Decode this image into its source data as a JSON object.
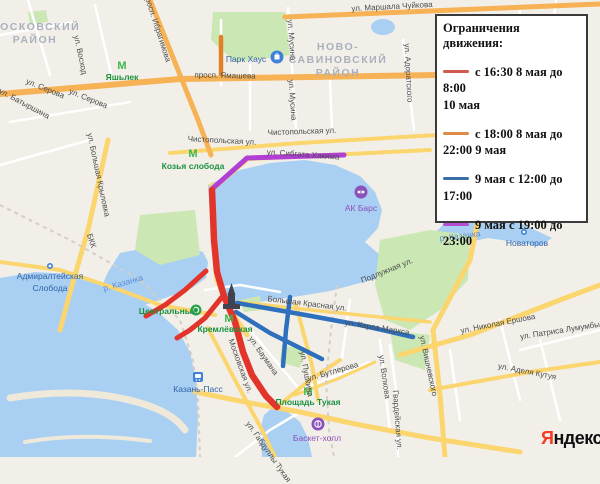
{
  "legend": {
    "title": "Ограничения движения:",
    "items": [
      {
        "color": "#cf5a50",
        "label": "с 16:30 8 мая до 8:00\n10 мая"
      },
      {
        "color": "#dd8b45",
        "label": "с 18:00 8 мая до\n22:00 9 мая"
      },
      {
        "color": "#3a6ea8",
        "label": "9 мая с 12:00 до\n17:00"
      },
      {
        "color": "#b44fd1",
        "label": "9 мая с 19:00 до\n23:00"
      }
    ]
  },
  "lines": {
    "red": "#e2342b",
    "orange": "#e08128",
    "blue": "#2e6fbe",
    "purple": "#b13fd4"
  },
  "icon_colors": {
    "metro_green": "#3cb64d",
    "place_blue": "#3f81d6",
    "venue_purple": "#8c50bb",
    "stadium_green": "#2aa34c"
  },
  "logo": {
    "ya": "Я",
    "rest": "ндекс"
  },
  "map": {
    "labels": [
      {
        "text": "МОСКОВСКИЙ",
        "x": 35,
        "y": 27,
        "r": 0,
        "c": "di"
      },
      {
        "text": "РАЙОН",
        "x": 35,
        "y": 40,
        "r": 0,
        "c": "di"
      },
      {
        "text": "НОВО-",
        "x": 338,
        "y": 47,
        "r": 0,
        "c": "di"
      },
      {
        "text": "САВИНОВСКИЙ",
        "x": 338,
        "y": 60,
        "r": 0,
        "c": "di"
      },
      {
        "text": "РАЙОН",
        "x": 338,
        "y": 73,
        "r": 0,
        "c": "di"
      },
      {
        "text": "ул. Маршала Чуйкова",
        "x": 392,
        "y": 7,
        "r": -3,
        "c": "st"
      },
      {
        "text": "просп. Ибрагимова",
        "x": 157,
        "y": 28,
        "r": 72,
        "c": "st"
      },
      {
        "text": "ул. Восход",
        "x": 80,
        "y": 55,
        "r": 78,
        "c": "st"
      },
      {
        "text": "ул. Серова",
        "x": 45,
        "y": 89,
        "r": 22,
        "c": "st"
      },
      {
        "text": "ул. Серова",
        "x": 88,
        "y": 99,
        "r": 22,
        "c": "st"
      },
      {
        "text": "ул. Батыршина",
        "x": 24,
        "y": 104,
        "r": 28,
        "c": "st"
      },
      {
        "text": "просп. Ямашева",
        "x": 225,
        "y": 76,
        "r": 1,
        "c": "st"
      },
      {
        "text": "ул. Мусина",
        "x": 291,
        "y": 40,
        "r": 86,
        "c": "st"
      },
      {
        "text": "ул. Мусина",
        "x": 292,
        "y": 100,
        "r": 86,
        "c": "st"
      },
      {
        "text": "ул. Адоратского",
        "x": 408,
        "y": 73,
        "r": 87,
        "c": "st"
      },
      {
        "text": "Чистопольская ул.",
        "x": 222,
        "y": 141,
        "r": 3,
        "c": "st"
      },
      {
        "text": "Чистопольская ул.",
        "x": 302,
        "y": 132,
        "r": -2,
        "c": "st"
      },
      {
        "text": "ул. Сибгата Хакима",
        "x": 303,
        "y": 155,
        "r": 4,
        "c": "st"
      },
      {
        "text": "ул. Большая Крыловка",
        "x": 98,
        "y": 175,
        "r": 78,
        "c": "st"
      },
      {
        "text": "БКК",
        "x": 91,
        "y": 241,
        "r": 72,
        "c": "st"
      },
      {
        "text": "Подлужная ул.",
        "x": 387,
        "y": 271,
        "r": -22,
        "c": "st"
      },
      {
        "text": "Большая Красная ул.",
        "x": 307,
        "y": 304,
        "r": 7,
        "c": "st"
      },
      {
        "text": "ул. Карла Маркса",
        "x": 377,
        "y": 328,
        "r": 9,
        "c": "st"
      },
      {
        "text": "ул. Баумана",
        "x": 263,
        "y": 356,
        "r": 55,
        "c": "st"
      },
      {
        "text": "ул. Пушкина",
        "x": 306,
        "y": 374,
        "r": 80,
        "c": "st"
      },
      {
        "text": "Московская ул.",
        "x": 240,
        "y": 366,
        "r": 70,
        "c": "st"
      },
      {
        "text": "ул. Бутлерова",
        "x": 333,
        "y": 372,
        "r": -16,
        "c": "st"
      },
      {
        "text": "ул. Волкова",
        "x": 384,
        "y": 377,
        "r": 82,
        "c": "st"
      },
      {
        "text": "ул. Вишневского",
        "x": 428,
        "y": 366,
        "r": 78,
        "c": "st"
      },
      {
        "text": "ул. Николая Ершова",
        "x": 498,
        "y": 324,
        "r": -11,
        "c": "st"
      },
      {
        "text": "ул. Патриса Лумумбы",
        "x": 560,
        "y": 331,
        "r": -9,
        "c": "st"
      },
      {
        "text": "Гвардейская ул.",
        "x": 397,
        "y": 420,
        "r": 86,
        "c": "st"
      },
      {
        "text": "ул. Аделя Кутуя",
        "x": 527,
        "y": 372,
        "r": 11,
        "c": "st"
      },
      {
        "text": "ул. Габдуллы Тукая",
        "x": 268,
        "y": 452,
        "r": 55,
        "c": "st"
      },
      {
        "text": "р. Казанка",
        "x": 123,
        "y": 283,
        "r": -16,
        "c": "wa"
      },
      {
        "text": "р. Казанка",
        "x": 460,
        "y": 236,
        "r": -7,
        "c": "wa"
      },
      {
        "text": "Яшьлек",
        "x": 122,
        "y": 77,
        "r": 0,
        "c": "me"
      },
      {
        "text": "Козья слобода",
        "x": 193,
        "y": 166,
        "r": 0,
        "c": "me"
      },
      {
        "text": "Кремлёвская",
        "x": 225,
        "y": 329,
        "r": 0,
        "c": "me"
      },
      {
        "text": "Площадь Тукая",
        "x": 308,
        "y": 402,
        "r": 0,
        "c": "me"
      },
      {
        "text": "Центральный",
        "x": 168,
        "y": 311,
        "r": 0,
        "c": "me"
      },
      {
        "text": "Парк Хаус",
        "x": 246,
        "y": 59,
        "r": 0,
        "c": "pl"
      },
      {
        "text": "Адмиралтейская",
        "x": 50,
        "y": 276,
        "r": 0,
        "c": "pl"
      },
      {
        "text": "Слобода",
        "x": 50,
        "y": 288,
        "r": 0,
        "c": "pl"
      },
      {
        "text": "Новаторов",
        "x": 527,
        "y": 243,
        "r": 0,
        "c": "pl"
      },
      {
        "text": "Казань-Пасс",
        "x": 198,
        "y": 389,
        "r": 0,
        "c": "pl"
      },
      {
        "text": "АК Барс",
        "x": 361,
        "y": 208,
        "r": 0,
        "c": "ve"
      },
      {
        "text": "Баскет-холл",
        "x": 317,
        "y": 438,
        "r": 0,
        "c": "ve"
      }
    ]
  }
}
